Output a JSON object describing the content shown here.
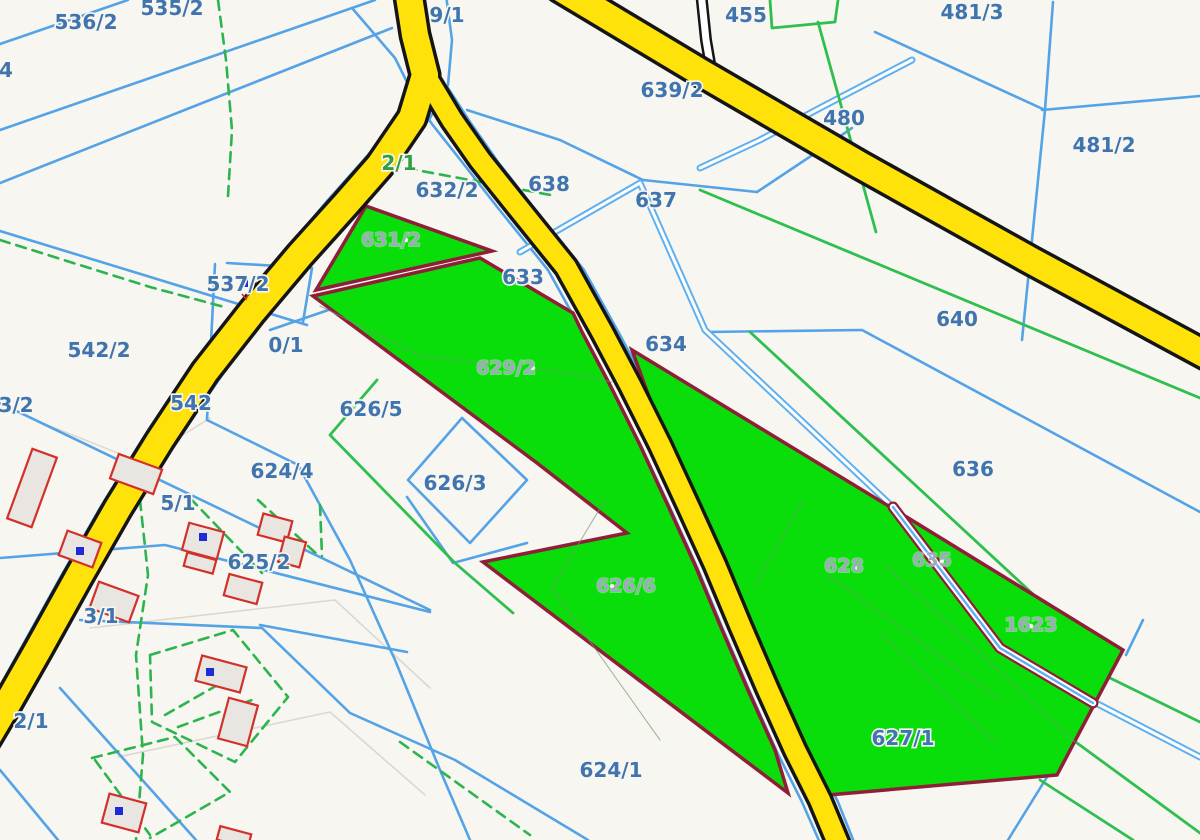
{
  "app": {
    "title": "Cadastral parcel map"
  },
  "palette": {
    "background": "#f7f6f1",
    "blue_line": "#54a3e6",
    "canal_blue": "#5fb0f0",
    "green_line": "#2fbf4e",
    "green_dash": "#2db44e",
    "pale_line": "#dbd8d0",
    "parcel_fill": "#0ade0a",
    "parcel_stroke": "#8f1f38",
    "faint_inner": "#6f9a6f",
    "road_yellow": "#ffe20a",
    "road_casing": "#151515",
    "road_white": "#ffffff",
    "building_fill": "#e9e5e1",
    "building_stroke": "#d2302a",
    "marker_blue": "#1f2bd8",
    "label_blue": "#3f74ae",
    "label_green": "#2f9e44",
    "label_on_green": "#9fa9bc",
    "halo": "#f7f6f1"
  },
  "map": {
    "width": 1200,
    "height": 840,
    "blue_lines": [
      {
        "pts": "0,130 375,0"
      },
      {
        "pts": "0,183 392,28"
      },
      {
        "pts": "0,44 128,0"
      },
      {
        "pts": "0,231 307,325"
      },
      {
        "pts": "227,263 312,268"
      },
      {
        "pts": "215,264 207,420"
      },
      {
        "pts": "207,420 296,464"
      },
      {
        "pts": "312,268 303,322"
      },
      {
        "pts": "270,330 480,258 545,300"
      },
      {
        "pts": "0,403 430,610"
      },
      {
        "pts": "0,558 165,545 430,612"
      },
      {
        "pts": "80,620 262,628 350,713 455,760 588,840"
      },
      {
        "pts": "60,688 196,840"
      },
      {
        "pts": "0,770 58,840"
      },
      {
        "pts": "297,463 350,560 395,660 440,770 470,840"
      },
      {
        "pts": "260,625 407,652"
      },
      {
        "pts": "462,418 527,480 470,543 408,480 462,418"
      },
      {
        "pts": "407,497 453,563 527,543"
      },
      {
        "pts": "875,32 1045,110"
      },
      {
        "pts": "1053,2 1045,110"
      },
      {
        "pts": "1045,110 1022,340"
      },
      {
        "pts": "1042,110 1200,96"
      },
      {
        "pts": "705,332 862,330 1200,512"
      },
      {
        "pts": "467,110 560,140 643,180"
      },
      {
        "pts": "643,180 757,192"
      },
      {
        "pts": "757,192 808,158 852,128"
      },
      {
        "pts": "352,8 395,58 412,92"
      },
      {
        "pts": "1047,777 1008,840"
      },
      {
        "pts": "1143,620 1126,655"
      },
      {
        "pts": "398,-5 404,40 412,80 398,120 362,162 328,200 282,255 234,312 188,372 142,440 100,508 60,578 20,650 -14,712"
      },
      {
        "pts": "446,-5 452,40 448,85 430,118 396,160 362,205 316,258 268,315 222,375 176,442 134,510 94,580 54,652 16,712"
      },
      {
        "pts": "448,88 470,122 498,162 534,208 584,270 620,335 648,388 678,448 708,512 733,567 758,627 786,692 813,752 838,802 858,852"
      },
      {
        "pts": "410,92 432,124 462,162 498,208 548,270 584,335 612,388 642,448 672,512 697,567 722,627 750,692 777,752 802,802 824,852"
      }
    ],
    "double_blue_lines": [
      {
        "pts": "520,252 640,183 705,330 787,407 898,512 1000,645 1090,700 1200,757"
      },
      {
        "pts": "700,168 760,140 820,108 912,60"
      }
    ],
    "green_solid_lines": [
      {
        "pts": "750,332 1048,608 1035,645"
      },
      {
        "pts": "700,190 1200,398"
      },
      {
        "pts": "818,22 876,232"
      },
      {
        "pts": "770,0 772,28 835,22 838,0"
      },
      {
        "pts": "377,380 330,435 455,563 513,613"
      },
      {
        "pts": "1110,678 1200,722"
      },
      {
        "pts": "1077,743 1200,833"
      },
      {
        "pts": "1040,780 1133,840"
      }
    ],
    "green_dashed_lines": [
      {
        "pts": "218,0 226,60 232,130 228,196"
      },
      {
        "pts": "0,240 150,287 228,308"
      },
      {
        "pts": "373,162 556,196"
      },
      {
        "pts": "140,500 148,575 136,655 143,755 136,840"
      },
      {
        "pts": "150,655 233,630 288,697 235,762 152,722 150,655"
      },
      {
        "pts": "165,715 235,675"
      },
      {
        "pts": "178,727 252,700"
      },
      {
        "pts": "92,758 175,737 230,792 150,838"
      },
      {
        "pts": "95,760 150,835"
      },
      {
        "pts": "190,498 262,573"
      },
      {
        "pts": "258,500 320,557"
      },
      {
        "pts": "320,505 322,556"
      },
      {
        "pts": "400,742 530,835"
      }
    ],
    "pale_lines": [
      {
        "pts": "90,628 335,600 430,688"
      },
      {
        "pts": "118,757 330,712 425,795"
      },
      {
        "pts": "30,418 140,462 210,418"
      }
    ],
    "parcels": [
      {
        "id": "631/2",
        "pts": "366,206 492,251 316,290"
      },
      {
        "id": "629/2 626/6",
        "pts": "313,296 480,258 573,313 582,332 610,385 640,445 670,510 695,565 720,625 748,690 775,750 788,793 483,562 627,533 537,463"
      },
      {
        "id": "628 635 1623",
        "pts": "632,350 905,516 1123,650 1057,775 828,795 805,755 778,700 752,640 728,585 705,530 680,470 652,405"
      }
    ],
    "faint_inner_lines": [
      {
        "pts": "320,306 420,356 575,374 612,382"
      },
      {
        "pts": "605,500 552,588"
      },
      {
        "pts": "552,588 660,740"
      },
      {
        "pts": "803,500 755,585"
      },
      {
        "pts": "828,575 1000,700"
      },
      {
        "pts": "885,565 1075,742"
      },
      {
        "pts": "880,633 995,742"
      }
    ],
    "corridor_canal": {
      "pts": "893,507 1000,648 1093,703"
    },
    "roads": {
      "white": [
        {
          "pts": "701,-8 706,40 712,75",
          "w": 7
        }
      ],
      "yellow": [
        {
          "name": "road-north",
          "pts": "408,-10 415,35 425,75",
          "w": 26
        },
        {
          "name": "road-southwest",
          "pts": "425,75 412,118 380,165 345,205 300,255 252,312 205,372 160,440 118,508 78,578 38,650 5,708 -20,750",
          "w": 26
        },
        {
          "name": "road-central",
          "pts": "428,80 452,120 480,160 516,205 566,267 602,332 630,385 660,445 690,510 715,565 740,625 768,690 795,750 820,800 845,860",
          "w": 20
        },
        {
          "name": "road-northeast",
          "pts": "560,-12 700,72 860,165 1030,260 1215,360",
          "w": 26
        }
      ]
    },
    "buildings": [
      {
        "cx": 32,
        "cy": 488,
        "w": 26,
        "h": 74,
        "rot": 20
      },
      {
        "cx": 136,
        "cy": 474,
        "w": 46,
        "h": 26,
        "rot": 20
      },
      {
        "cx": 80,
        "cy": 549,
        "w": 36,
        "h": 26,
        "rot": 20
      },
      {
        "cx": 114,
        "cy": 602,
        "w": 42,
        "h": 28,
        "rot": 20
      },
      {
        "cx": 203,
        "cy": 541,
        "w": 36,
        "h": 28,
        "rot": 15
      },
      {
        "cx": 200,
        "cy": 563,
        "w": 30,
        "h": 14,
        "rot": 15
      },
      {
        "cx": 275,
        "cy": 528,
        "w": 30,
        "h": 22,
        "rot": 15
      },
      {
        "cx": 292,
        "cy": 552,
        "w": 22,
        "h": 26,
        "rot": 15
      },
      {
        "cx": 243,
        "cy": 589,
        "w": 34,
        "h": 22,
        "rot": 15
      },
      {
        "cx": 221,
        "cy": 674,
        "w": 46,
        "h": 26,
        "rot": 15
      },
      {
        "cx": 238,
        "cy": 722,
        "w": 30,
        "h": 42,
        "rot": 15
      },
      {
        "cx": 124,
        "cy": 813,
        "w": 38,
        "h": 30,
        "rot": 15
      },
      {
        "cx": 234,
        "cy": 837,
        "w": 32,
        "h": 14,
        "rot": 15
      }
    ],
    "point_markers": [
      [
        244,
        283
      ],
      [
        80,
        551
      ],
      [
        203,
        537
      ],
      [
        210,
        672
      ],
      [
        119,
        811
      ]
    ],
    "red_tick": {
      "x": 246,
      "y": 294
    },
    "label_dots": [
      [
        533,
        368
      ],
      [
        612,
        586
      ],
      [
        646,
        586
      ],
      [
        855,
        568
      ],
      [
        1031,
        626
      ],
      [
        406,
        240
      ],
      [
        942,
        561
      ]
    ],
    "labels": [
      {
        "t": "536/2",
        "x": 86,
        "y": 22,
        "k": "blue"
      },
      {
        "t": "535/2",
        "x": 172,
        "y": 8,
        "k": "blue"
      },
      {
        "t": "4",
        "x": 6,
        "y": 70,
        "k": "blue"
      },
      {
        "t": "9/1",
        "x": 447,
        "y": 15,
        "k": "blue"
      },
      {
        "t": "639/2",
        "x": 672,
        "y": 90,
        "k": "blue"
      },
      {
        "t": "455",
        "x": 746,
        "y": 15,
        "k": "blue"
      },
      {
        "t": "481/3",
        "x": 972,
        "y": 12,
        "k": "blue"
      },
      {
        "t": "480",
        "x": 844,
        "y": 118,
        "k": "blue"
      },
      {
        "t": "481/2",
        "x": 1104,
        "y": 145,
        "k": "blue"
      },
      {
        "t": "2/1",
        "x": 399,
        "y": 163,
        "k": "green"
      },
      {
        "t": "632/2",
        "x": 447,
        "y": 190,
        "k": "blue"
      },
      {
        "t": "638",
        "x": 549,
        "y": 184,
        "k": "blue"
      },
      {
        "t": "637",
        "x": 656,
        "y": 200,
        "k": "blue"
      },
      {
        "t": "633",
        "x": 523,
        "y": 277,
        "k": "blue"
      },
      {
        "t": "537/2",
        "x": 238,
        "y": 284,
        "k": "blue"
      },
      {
        "t": "634",
        "x": 666,
        "y": 344,
        "k": "blue"
      },
      {
        "t": "640",
        "x": 957,
        "y": 319,
        "k": "blue"
      },
      {
        "t": "0/1",
        "x": 286,
        "y": 345,
        "k": "blue"
      },
      {
        "t": "542/2",
        "x": 99,
        "y": 350,
        "k": "blue"
      },
      {
        "t": "3/2",
        "x": 16,
        "y": 405,
        "k": "blue"
      },
      {
        "t": "542",
        "x": 191,
        "y": 403,
        "k": "blue"
      },
      {
        "t": "626/5",
        "x": 371,
        "y": 409,
        "k": "blue"
      },
      {
        "t": "624/4",
        "x": 282,
        "y": 471,
        "k": "blue"
      },
      {
        "t": "626/3",
        "x": 455,
        "y": 483,
        "k": "blue"
      },
      {
        "t": "636",
        "x": 973,
        "y": 469,
        "k": "blue"
      },
      {
        "t": "5/1",
        "x": 178,
        "y": 503,
        "k": "blue"
      },
      {
        "t": "625/2",
        "x": 259,
        "y": 562,
        "k": "blue"
      },
      {
        "t": "3/1",
        "x": 101,
        "y": 616,
        "k": "blue"
      },
      {
        "t": "2/1",
        "x": 31,
        "y": 721,
        "k": "blue"
      },
      {
        "t": "627/1",
        "x": 903,
        "y": 738,
        "k": "blue"
      },
      {
        "t": "624/1",
        "x": 611,
        "y": 770,
        "k": "blue"
      },
      {
        "t": "631/2",
        "x": 391,
        "y": 240,
        "k": "ongreen"
      },
      {
        "t": "629/2",
        "x": 506,
        "y": 368,
        "k": "ongreen"
      },
      {
        "t": "626/6",
        "x": 626,
        "y": 586,
        "k": "ongreen"
      },
      {
        "t": "628",
        "x": 844,
        "y": 566,
        "k": "ongreen"
      },
      {
        "t": "635",
        "x": 932,
        "y": 560,
        "k": "ongreen"
      },
      {
        "t": "1623",
        "x": 1031,
        "y": 625,
        "k": "ongreen"
      }
    ]
  }
}
